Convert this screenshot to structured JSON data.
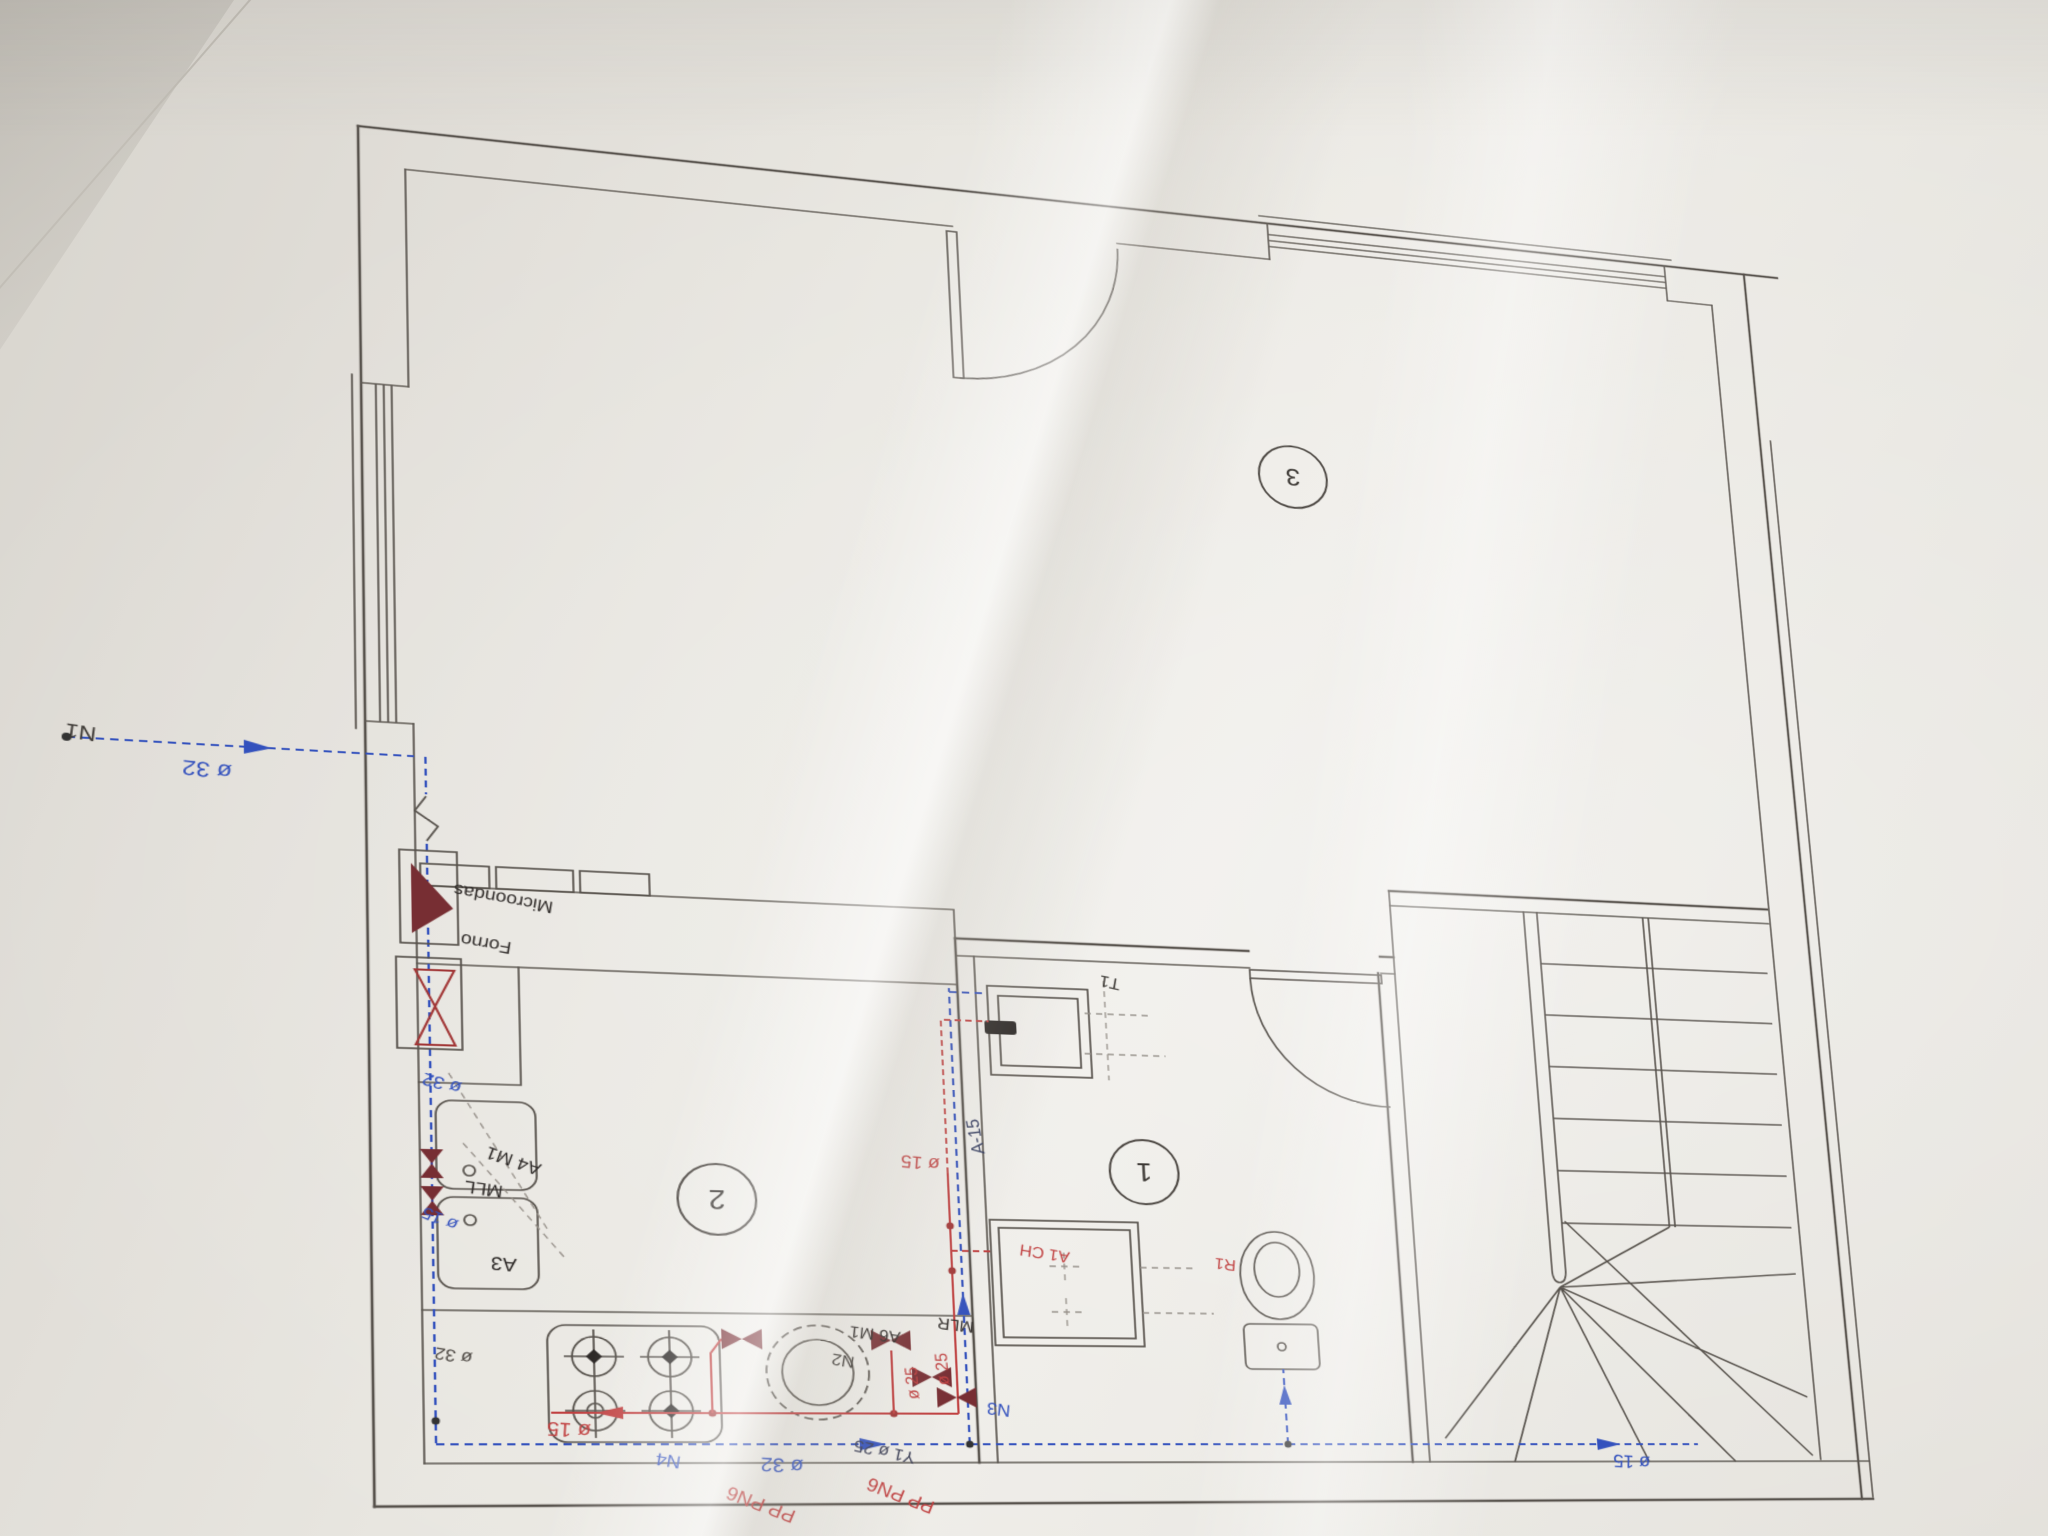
{
  "meta": {
    "description": "Photographed architectural floor plan with hand-drawn plumbing annotations; the sheet was photographed upside-down so all lettering reads rotated 180 degrees",
    "drawing_type": "kitchen / bathroom water-supply plan"
  },
  "rooms": {
    "bathroom_number": "1",
    "kitchen_number": "2",
    "living_number": "3"
  },
  "labels": {
    "n1": "N1",
    "dia32_entry": "ø 32",
    "dia32_wall": "ø 32",
    "dia32_corner": "ø 32",
    "dia32_main": "ø 32",
    "forno": "Forno",
    "microondas": "Microondas",
    "mll": "MLL",
    "a4_m1": "A4 M1",
    "a3": "A3",
    "a6_m1": "A6 M1",
    "mlr": "MLR",
    "dia15_blue_sink": "ø 15",
    "dia15_hot": "ø 15",
    "dia15_riser": "ø 15",
    "dia15_main": "ø 15",
    "dia25_boiler": "ø 25",
    "dia25_riser": "ø 25",
    "y1_dia25": "Y1 ø 25",
    "pp_pn6_a": "PP PN6",
    "pp_pn6_b": "PP PN6",
    "n2": "N2",
    "n3": "N3",
    "n4": "N4",
    "a15": "A-15",
    "a1_ch": "A1 CH",
    "t1": "T1",
    "r1": "R1"
  },
  "colors": {
    "cold_water": "#3351bd",
    "hot_water": "#c04040",
    "valve": "#772e33",
    "wall_line": "#57524c",
    "paper": "#e7e5df"
  }
}
